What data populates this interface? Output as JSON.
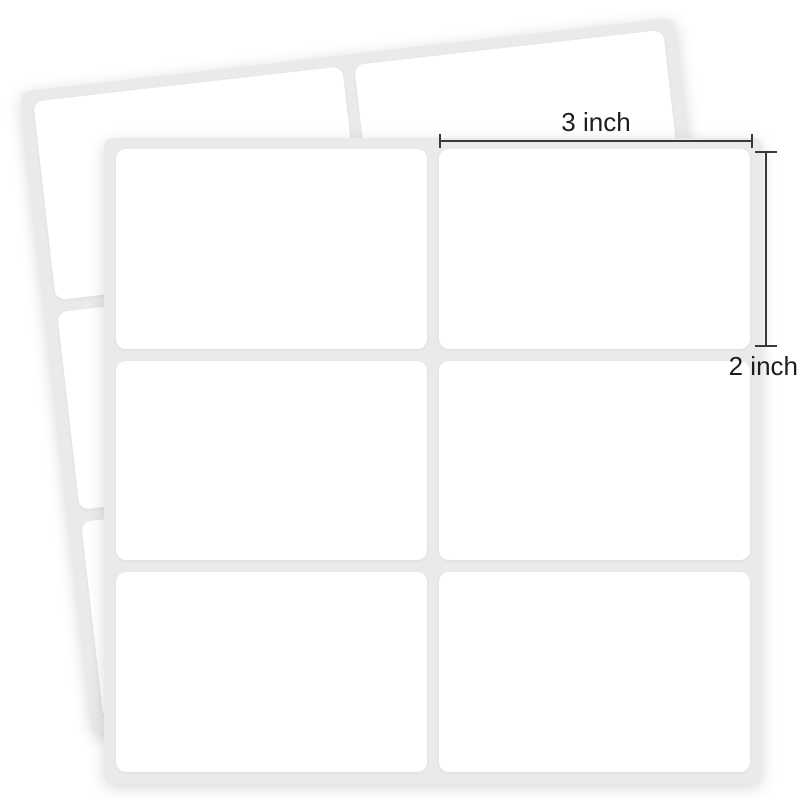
{
  "annotations": {
    "width": {
      "label": "3 inch"
    },
    "height": {
      "label": "2 inch"
    }
  },
  "sheets": {
    "back": {
      "rows": 3,
      "cols": 2,
      "blank_labels": 6
    },
    "front": {
      "rows": 3,
      "cols": 2,
      "blank_labels": 6
    }
  },
  "colors": {
    "background": "#ffffff",
    "sheet": "#e9eaec",
    "label": "#ffffff",
    "dimension_line": "#3a3a3a",
    "annotation_text": "#1d1d1d"
  }
}
